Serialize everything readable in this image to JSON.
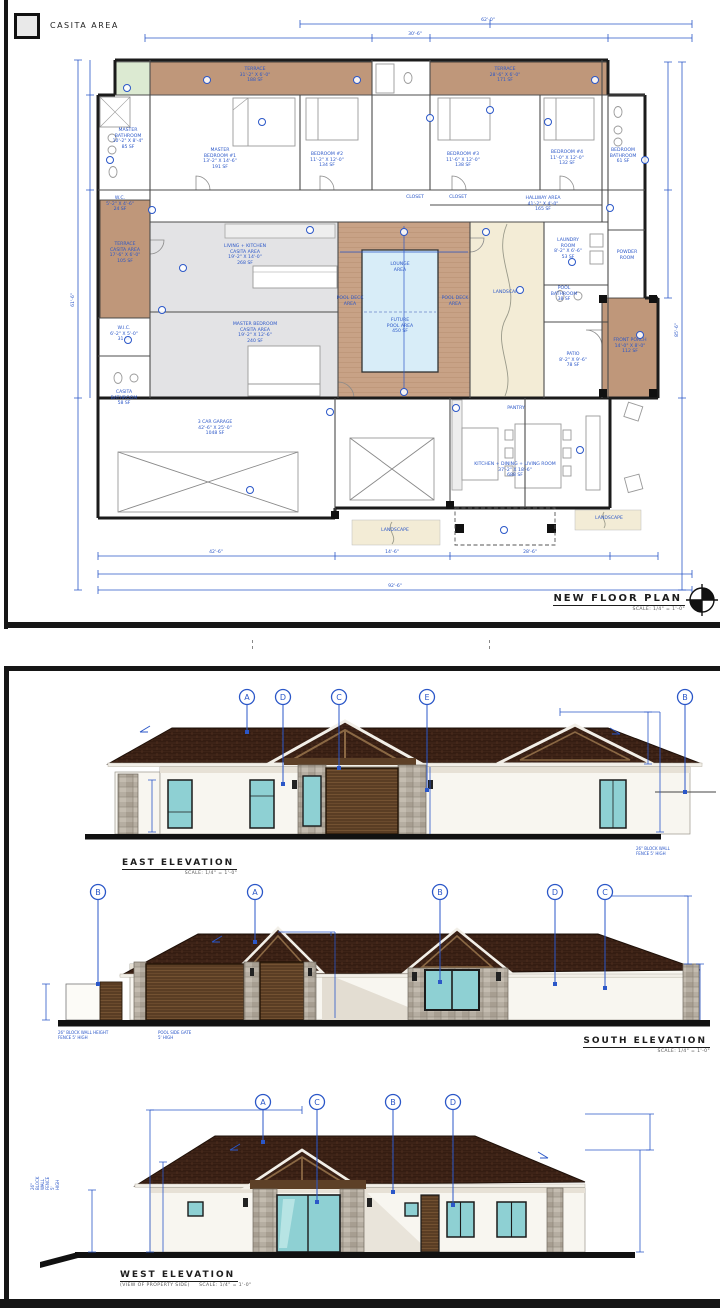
{
  "sheet1": {
    "legend_label": "CASITA AREA",
    "title": "NEW FLOOR PLAN",
    "scale": "SCALE: 1/4\" = 1'-0\"",
    "rooms": {
      "terrace_a": "TERRACE\n31'-2\" X 6'-0\"\n188 SF",
      "terrace_b": "TERRACE\n28'-6\" X 6'-0\"\n171 SF",
      "master_bath": "MASTER\nBATHROOM\n10'-2\" X 8'-4\"\n85 SF",
      "wc": "W.C.\n5'-2\" X 4'-6\"\n24 SF",
      "master_bed": "MASTER\nBEDROOM #1\n13'-2\" X 14'-6\"\n191 SF",
      "bed2": "BEDROOM #2\n11'-2\" X 12'-0\"\n134 SF",
      "bed3": "BEDROOM #3\n11'-6\" X 12'-0\"\n138 SF",
      "bed4": "BEDROOM #4\n11'-0\" X 12'-0\"\n132 SF",
      "bed_bath": "BEDROOM\nBATHROOM\n61 SF",
      "hallway": "HALLWAY AREA\n41'-2\" X 4'-0\"\n165 SF",
      "closet1": "CLOSET",
      "closet2": "CLOSET",
      "living_casita": "LIVING + KITCHEN\nCASITA AREA\n19'-2\" X 14'-0\"\n268 SF",
      "master_casita": "MASTER BEDROOM\nCASITA AREA\n19'-2\" X 12'-6\"\n240 SF",
      "terrace_casita": "TERRACE\nCASITA AREA\n17'-6\" X 6'-0\"\n105 SF",
      "wic": "W.I.C.\n6'-2\" X 5'-0\"\n31 SF",
      "casita_bath": "CASITA\nBATHROOM\n58 SF",
      "lounge": "LOUNGE\nAREA",
      "future_pool": "FUTURE\nPOOL AREA\n450 SF",
      "pool_deck_l": "POOL DECK\nAREA",
      "pool_deck_r": "POOL DECK\nAREA",
      "landscape_c": "LANDSCAPE",
      "landscape_bl": "LANDSCAPE",
      "landscape_br": "LANDSCAPE",
      "laundry": "LAUNDRY\nROOM\n8'-2\" X 6'-6\"\n53 SF",
      "powder": "POWDER\nROOM",
      "pool_bath": "POOL\nBATHROOM\n38 SF",
      "patio": "PATIO\n8'-2\" X 9'-6\"\n78 SF",
      "front_porch": "FRONT PORCH\n14'-0\" X 8'-0\"\n112 SF",
      "garage": "3  CAR  GARAGE\n42'-6\" X 25'-0\"\n1048 SF",
      "pantry": "PANTRY",
      "kdl": "KITCHEN  +  DINING  +  LIVING ROOM\n37'-2\" X 18'-6\"\n688 SF"
    },
    "dims": {
      "t1": "62'-0\"",
      "t2": "30'-6\"",
      "l1": "61'-6\"",
      "r1": "85'-6\"",
      "b1": "42'-6\"",
      "b2": "14'-6\"",
      "b3": "28'-6\"",
      "bt": "92'-6\""
    }
  },
  "elevations": [
    {
      "title": "EAST ELEVATION",
      "scale": "SCALE: 1/4\" = 1'-0\"",
      "markers": [
        "A",
        "D",
        "C",
        "E",
        "B"
      ],
      "note": "26\" BLOCK WALL\nFENCE 5' HIGH"
    },
    {
      "title": "SOUTH ELEVATION",
      "scale": "SCALE: 1/4\" = 1'-0\"",
      "markers": [
        "B",
        "A",
        "B",
        "D",
        "C"
      ],
      "notes": [
        "26\" BLOCK WALL HEIGHT\nFENCE 5' HIGH",
        "POOL SIDE GATE\n5' HIGH"
      ]
    },
    {
      "title": "WEST ELEVATION",
      "scale": "SCALE: 1/4\" = 1'-0\"",
      "subtitle": "(VIEW OF PROPERTY SIDE)",
      "markers": [
        "A",
        "C",
        "B",
        "D"
      ],
      "note": "26\" BLOCK WALL\nFENCE 5' HIGH"
    }
  ]
}
